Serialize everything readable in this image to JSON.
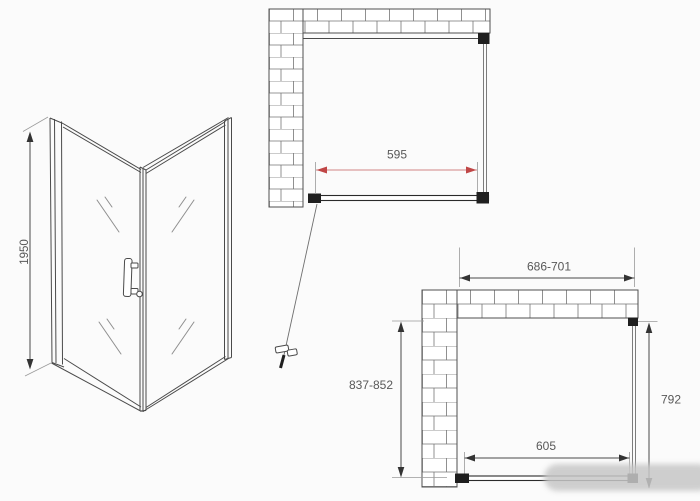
{
  "drawing": {
    "labels": {
      "perspective_height": "1950",
      "open_plan_width": "595",
      "install_outer_width": "686-701",
      "install_left_range": "837-852",
      "install_panel_depth": "792",
      "install_door_width": "605"
    },
    "colors": {
      "background": "#fbfbfb",
      "line": "#4a4a4a",
      "dark_fitting": "#1f1f1f",
      "brick_line": "#757575",
      "dimension_text": "#585858",
      "accent_red": "#c04646",
      "accent_red_light": "#d08585",
      "smudge": "#c7c7c7"
    }
  }
}
